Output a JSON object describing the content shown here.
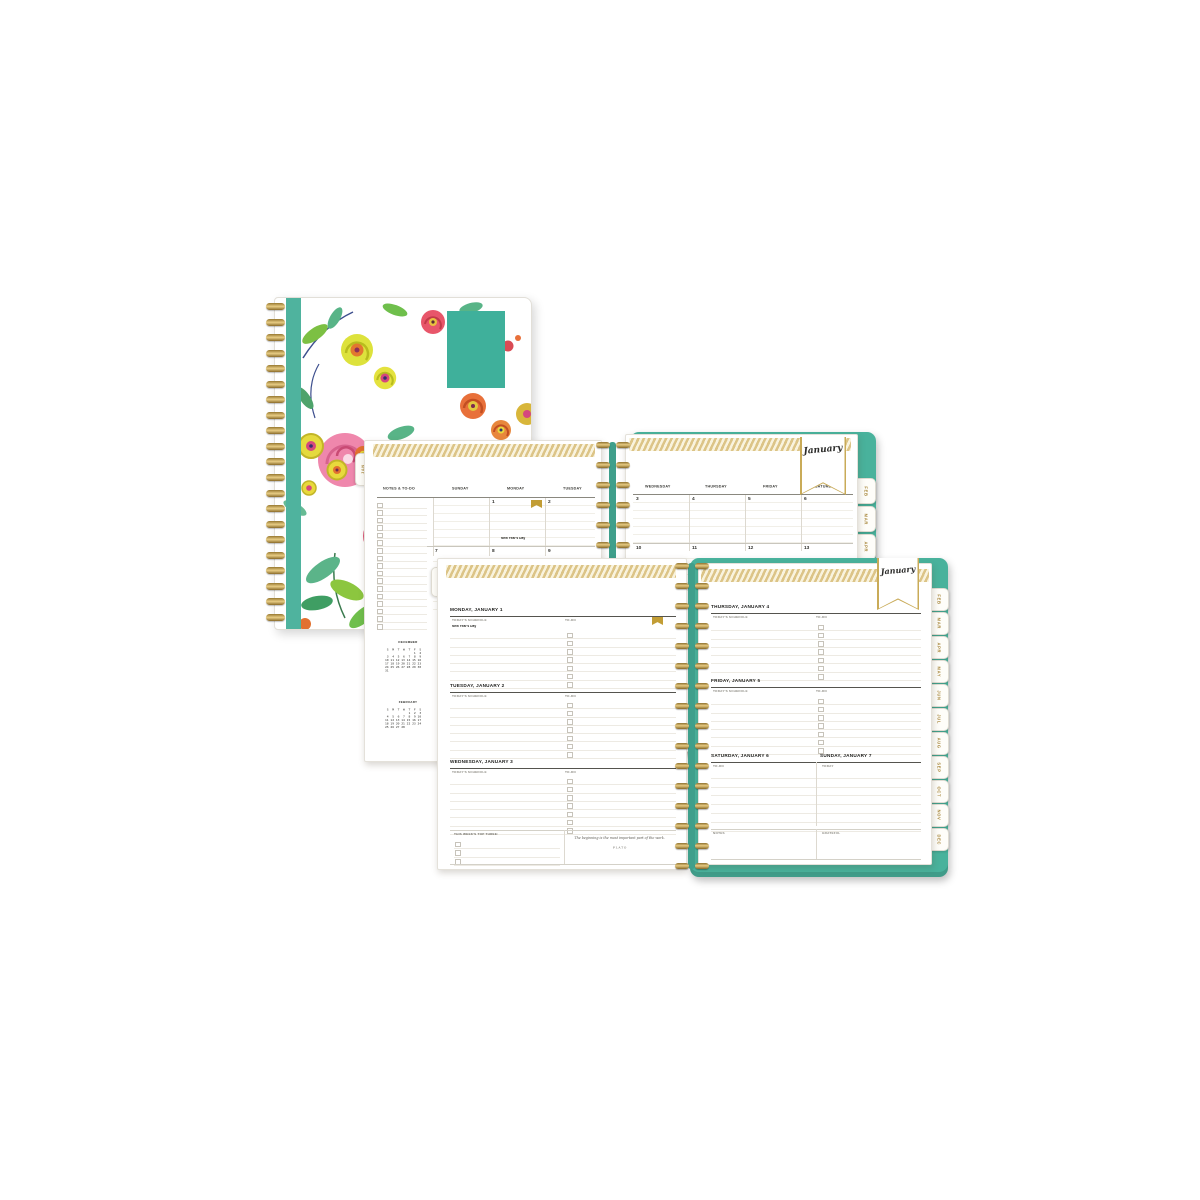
{
  "product": {
    "accent_teal": "#49b29c",
    "accent_gold": "#b28f3e",
    "cover_style": "white floral print with pink roses, yellow blooms and green leaves"
  },
  "monthly": {
    "jan_tab": "JAN",
    "month_banner": "January",
    "notes_header": "NOTES & TO-DO",
    "day_headers": [
      "SUNDAY",
      "MONDAY",
      "TUESDAY",
      "WEDNESDAY",
      "THURSDAY",
      "FRIDAY",
      "SATURDAY"
    ],
    "week1": [
      "",
      "1",
      "2",
      "3",
      "4",
      "5",
      "6"
    ],
    "week2": [
      "7",
      "8",
      "9",
      "10",
      "11",
      "12",
      "13"
    ],
    "holiday": "New Year's Day",
    "side_tabs": [
      "FEB",
      "MAR",
      "APR",
      "MAY"
    ],
    "minicals": [
      {
        "title": "DECEMBER",
        "rows_text": " S  M  T  W  T  F  S\n                1  2\n 3  4  5  6  7  8  9\n10 11 12 13 14 15 16\n17 18 19 20 21 22 23\n24 25 26 27 28 29 30\n31"
      },
      {
        "title": "FEBRUARY",
        "rows_text": " S  M  T  W  T  F  S\n             1  2  3\n 4  5  6  7  8  9 10\n11 12 13 14 15 16 17\n18 19 20 21 22 23 24\n25 26 27 28"
      }
    ]
  },
  "weekly": {
    "jan_tab": "JAN",
    "month_banner": "January",
    "days": [
      {
        "title": "MONDAY, JANUARY 1",
        "schedule_label": "TODAY'S SCHEDULE",
        "todo_label": "TO-DO",
        "note": "New Year's Day"
      },
      {
        "title": "TUESDAY, JANUARY 2",
        "schedule_label": "TODAY'S SCHEDULE",
        "todo_label": "TO-DO"
      },
      {
        "title": "WEDNESDAY, JANUARY 3",
        "schedule_label": "TODAY'S SCHEDULE",
        "todo_label": "TO-DO"
      },
      {
        "title": "THURSDAY, JANUARY 4",
        "schedule_label": "TODAY'S SCHEDULE",
        "todo_label": "TO-DO"
      },
      {
        "title": "FRIDAY, JANUARY 5",
        "schedule_label": "TODAY'S SCHEDULE",
        "todo_label": "TO-DO"
      },
      {
        "title": "SATURDAY, JANUARY 6",
        "label": "TO-DO"
      },
      {
        "title": "SUNDAY, JANUARY 7",
        "label": "TODAY"
      }
    ],
    "top_three_label": "THIS WEEK'S TOP THREE:",
    "quote": {
      "text": "The beginning is the most important part of the work.",
      "author": "PLATO"
    },
    "notes_label": "NOTES",
    "grateful_label": "GRATEFUL",
    "side_tabs": [
      "FEB",
      "MAR",
      "APR",
      "MAY",
      "JUN",
      "JUL",
      "AUG",
      "SEP",
      "OCT",
      "NOV",
      "DEC"
    ]
  }
}
